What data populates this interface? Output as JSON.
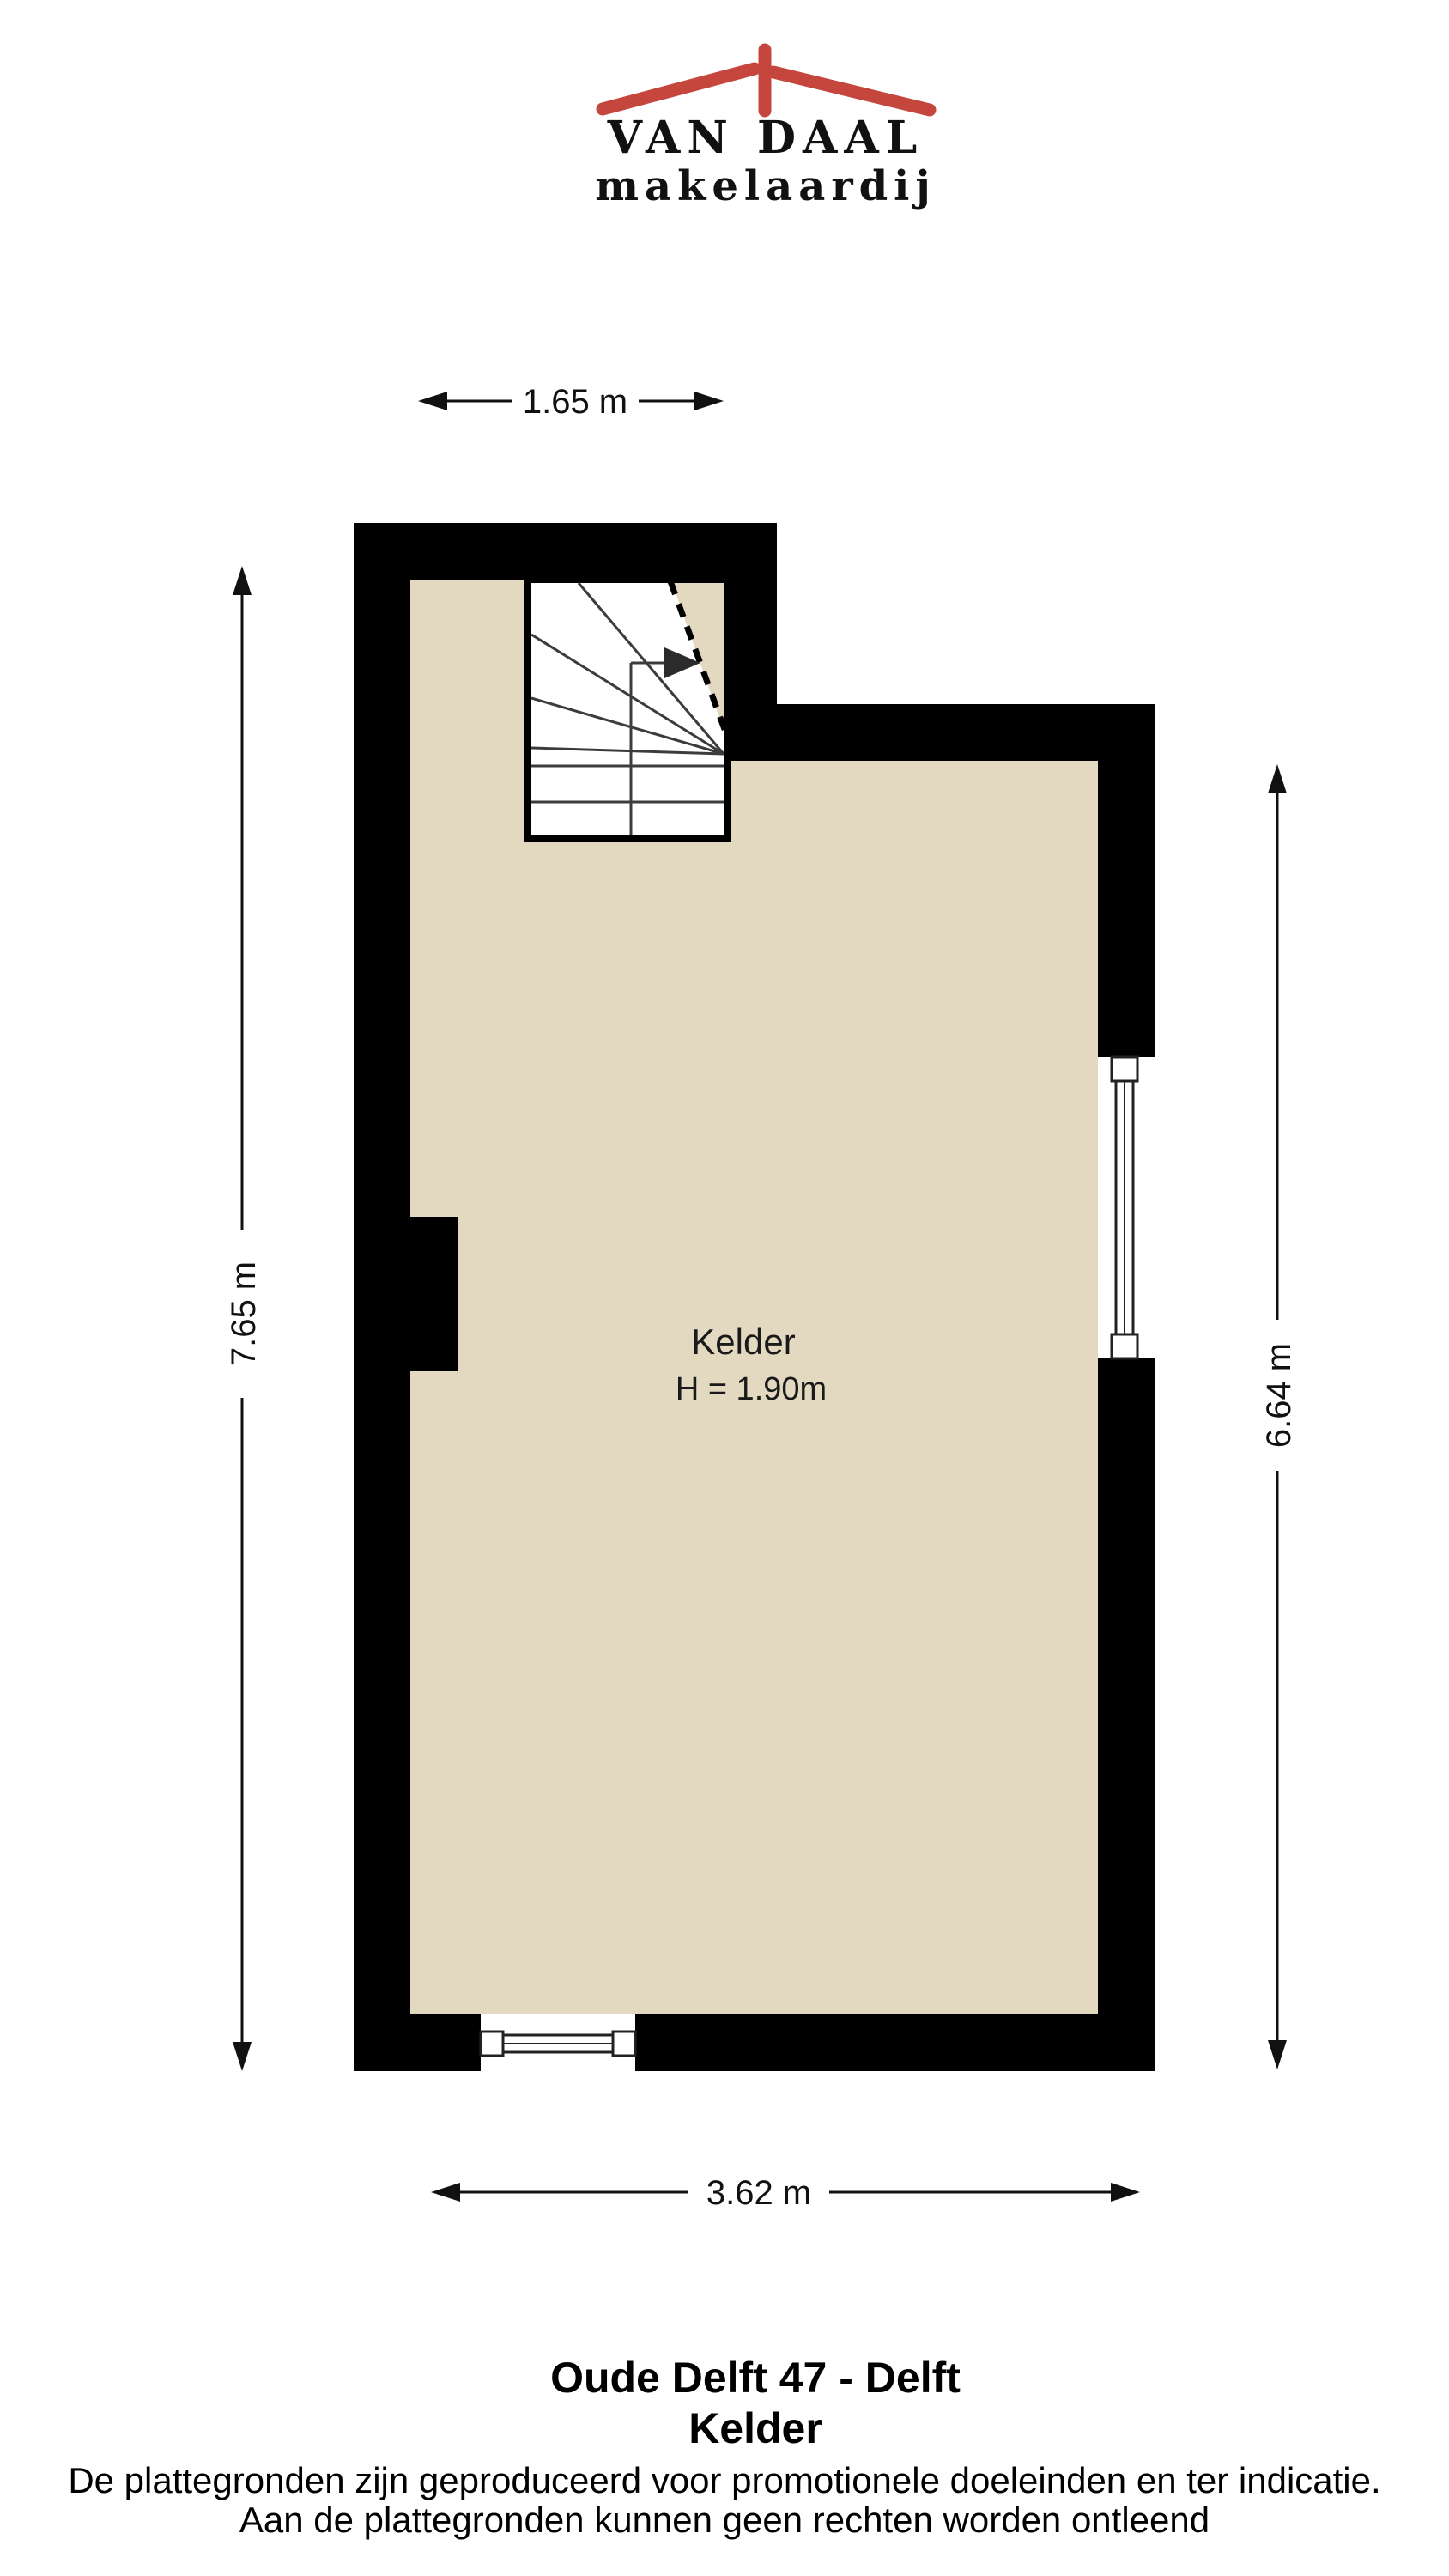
{
  "logo": {
    "name": "VAN DAAL",
    "tagline": "makelaardij",
    "roof_color": "#C5463D",
    "text_color": "#2B4A94"
  },
  "plan": {
    "room": {
      "label": "Kelder",
      "height_label": "H = 1.90m"
    },
    "dimensions": {
      "top": "1.65 m",
      "left": "7.65 m",
      "right": "6.64 m",
      "bottom": "3.62 m"
    },
    "colors": {
      "wall": "#000000",
      "floor": "#E3D9C1",
      "stair_outline": "#3C3C3C"
    }
  },
  "footer": {
    "address": "Oude Delft 47 - Delft",
    "floor_name": "Kelder",
    "disclaimer_line1": "De plattegronden zijn geproduceerd voor promotionele doeleinden en ter indicatie.",
    "disclaimer_line2": "Aan de plattegronden kunnen geen rechten worden ontleend"
  }
}
